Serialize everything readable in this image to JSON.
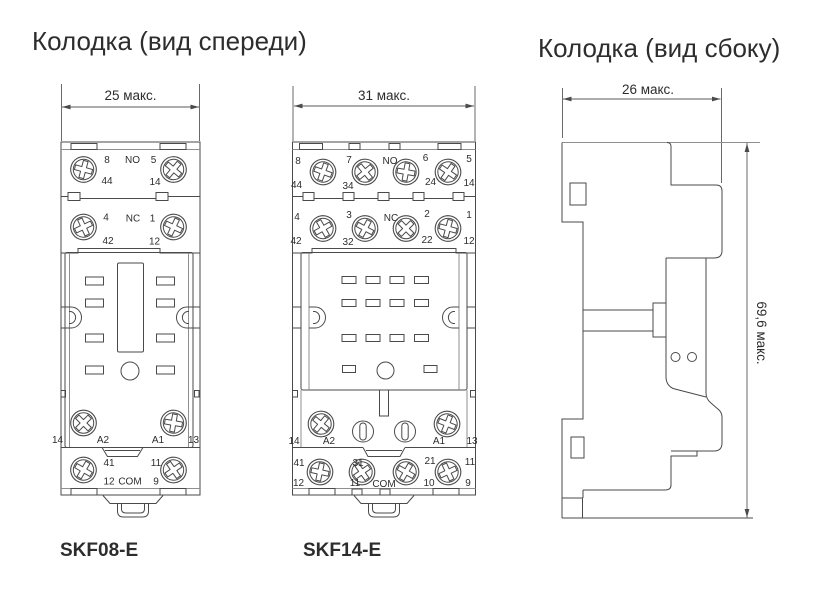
{
  "front_view": {
    "title": "Колодка (вид спереди)"
  },
  "side_view": {
    "title": "Колодка (вид сбоку)",
    "width_dim": "26 макс.",
    "height_dim": "69,6 макс."
  },
  "skf08": {
    "model": "SKF08-E",
    "width_dim": "25 макс.",
    "terminals": {
      "t8": "8",
      "no": "NO",
      "t5": "5",
      "t44": "44",
      "t14": "14",
      "t4": "4",
      "nc": "NC",
      "t1": "1",
      "t42": "42",
      "t12": "12",
      "a14": "14",
      "a2": "A2",
      "a1": "A1",
      "a13": "13",
      "b41": "41",
      "b11": "11",
      "b12": "12",
      "com": "COM",
      "b9": "9"
    }
  },
  "skf14": {
    "model": "SKF14-E",
    "width_dim": "31 макс.",
    "terminals": {
      "t8": "8",
      "t7": "7",
      "no": "NO",
      "t6": "6",
      "t5": "5",
      "t44": "44",
      "t34": "34",
      "t24": "24",
      "t14": "14",
      "t4": "4",
      "t3": "3",
      "nc": "NC",
      "t2": "2",
      "t1": "1",
      "t42": "42",
      "t32": "32",
      "t22": "22",
      "t12": "12",
      "a14": "14",
      "a2": "A2",
      "a1": "A1",
      "a13": "13",
      "b41": "41",
      "b31": "31",
      "b21": "21",
      "b11": "11",
      "c12": "12",
      "c11": "11",
      "com": "COM",
      "c10": "10",
      "c9": "9"
    }
  }
}
